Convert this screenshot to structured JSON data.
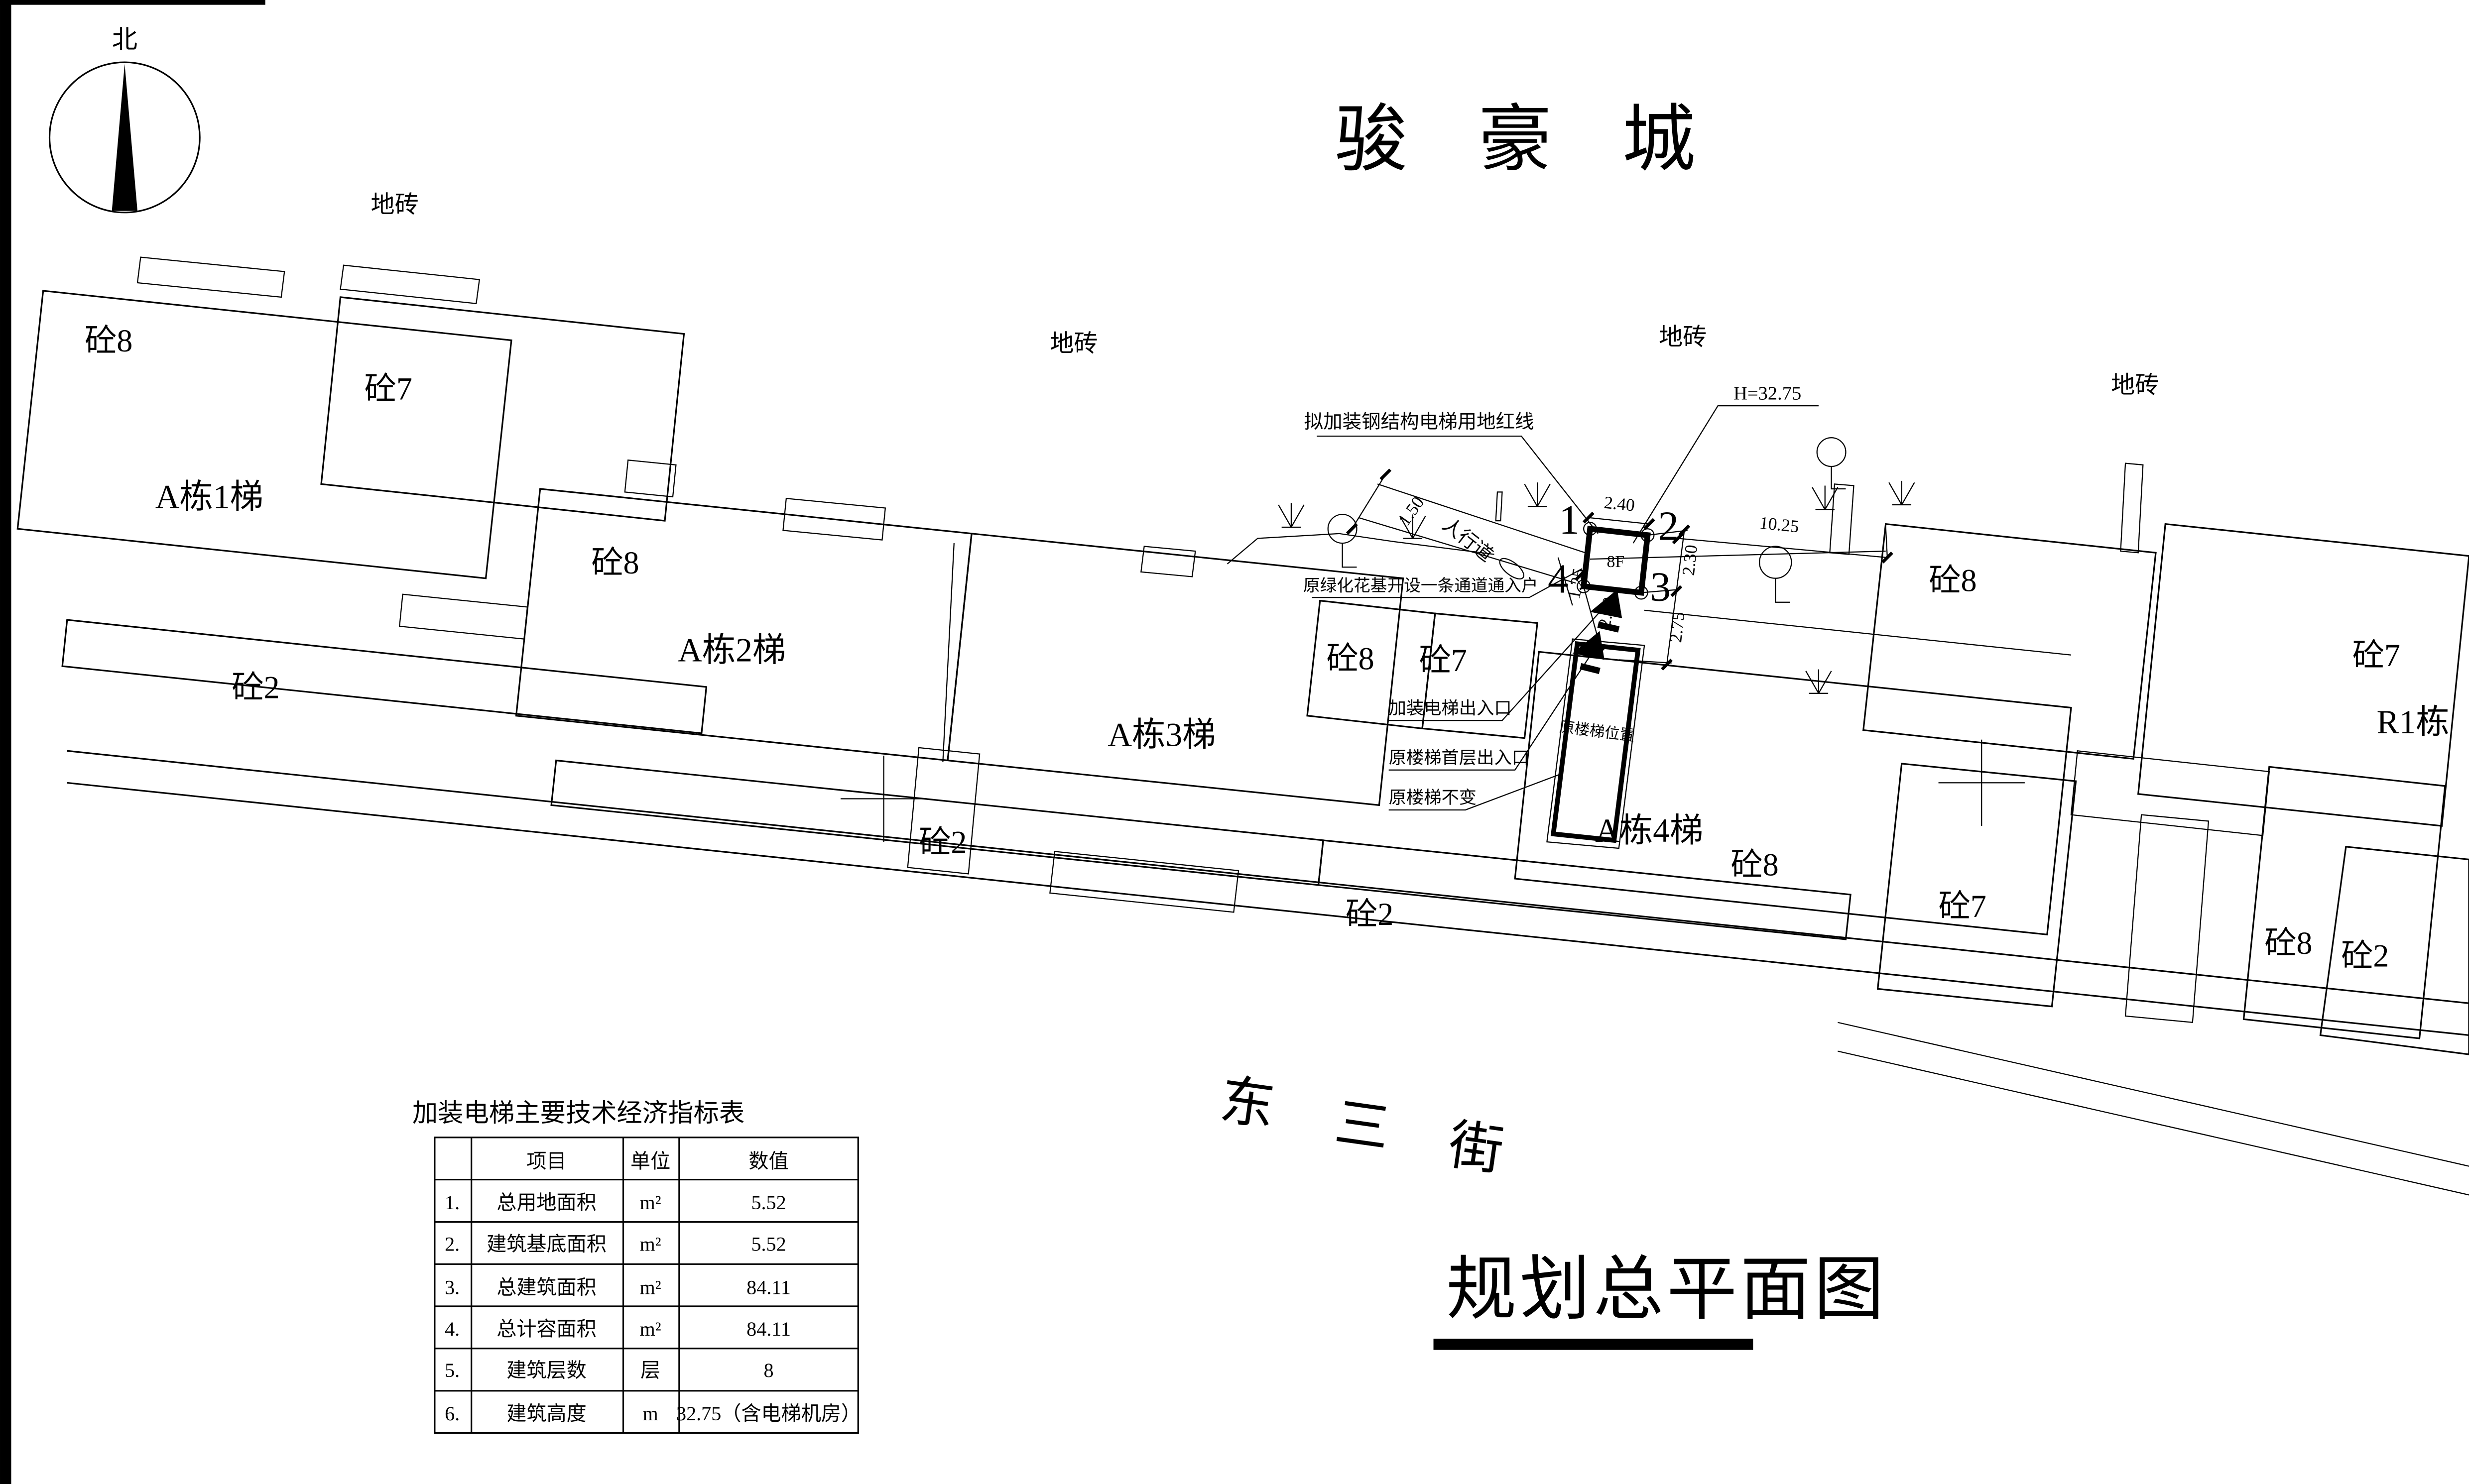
{
  "project_title": "骏豪城",
  "drawing_title": "规划总平面图",
  "compass": {
    "north_label": "北"
  },
  "surface_label": "地砖",
  "street_name": [
    "东",
    "三",
    "街"
  ],
  "building_labels": {
    "k8": "砼8",
    "k7": "砼7",
    "k2": "砼2",
    "a1": "A栋1梯",
    "a2": "A栋2梯",
    "a3": "A栋3梯",
    "a4": "A栋4梯",
    "r1": "R1栋"
  },
  "detail": {
    "red_line_note": "拟加装钢结构电梯用地红线",
    "height_note": "H=32.75",
    "walkway_label": "人行道",
    "green_note": "原绿化花基开设一条通道通入户",
    "elevator_entrance_note": "加装电梯出入口",
    "stair_entrance_note": "原楼梯首层出入口",
    "stair_unchanged_note": "原楼梯不变",
    "stair_location_label": "原楼梯位置",
    "floor_label": "8F",
    "points": [
      "1",
      "2",
      "3",
      "4"
    ],
    "dims": {
      "top": "2.40",
      "right_upper": "2.30",
      "right_lower": "2.75",
      "left": "2.30",
      "left_small": "1.25",
      "walkway_width": "1.50",
      "gap_to_building": "10.25"
    }
  },
  "table": {
    "title": "加装电梯主要技术经济指标表",
    "headers": [
      "项目",
      "单位",
      "数值"
    ],
    "rows": [
      [
        "1.",
        "总用地面积",
        "m²",
        "5.52"
      ],
      [
        "2.",
        "建筑基底面积",
        "m²",
        "5.52"
      ],
      [
        "3.",
        "总建筑面积",
        "m²",
        "84.11"
      ],
      [
        "4.",
        "总计容面积",
        "m²",
        "84.11"
      ],
      [
        "5.",
        "建筑层数",
        "层",
        "8"
      ],
      [
        "6.",
        "建筑高度",
        "m",
        "32.75（含电梯机房）"
      ]
    ]
  }
}
